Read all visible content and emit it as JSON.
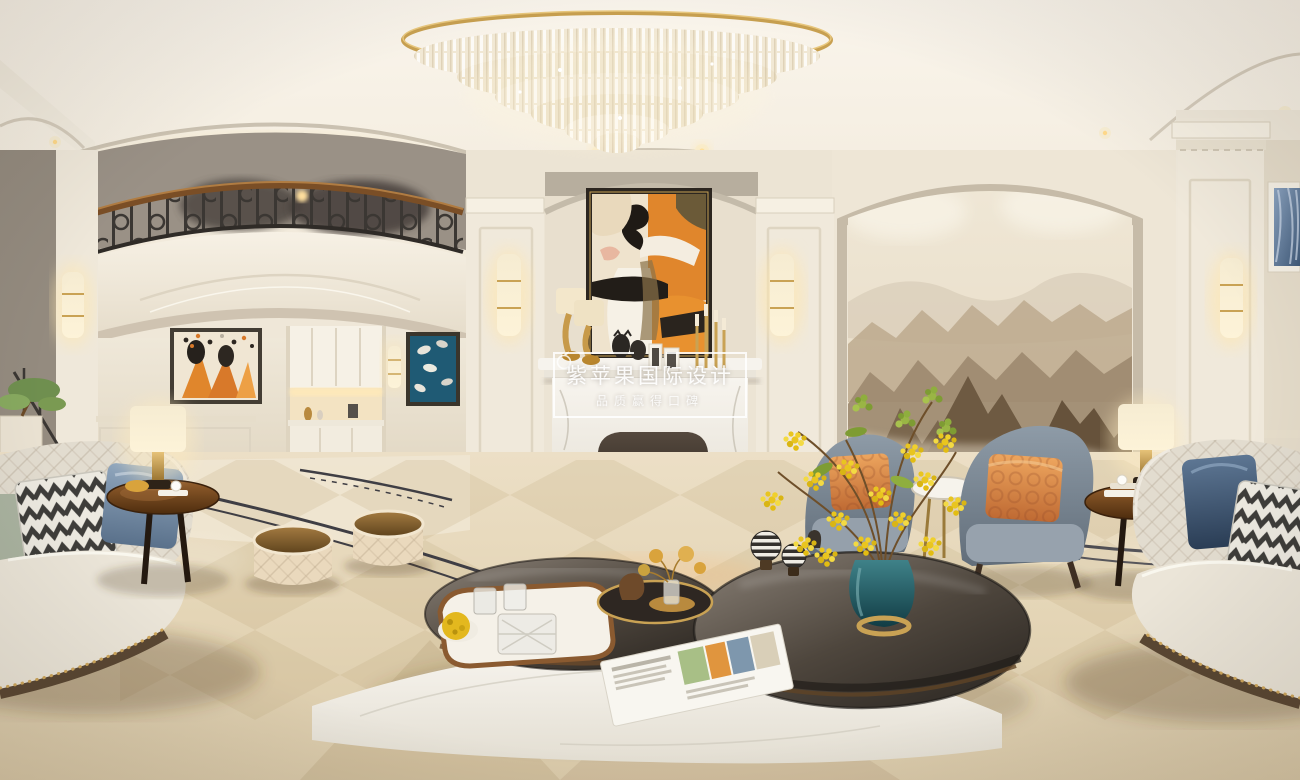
{
  "watermark": {
    "title": "紫苹果国际设计",
    "subtitle": "品质赢得口碑",
    "logo_icon": "apple-outline-icon"
  },
  "scene": {
    "kind": "360-degree interior panorama render",
    "room": "luxury neoclassical living room",
    "objects": [
      "crystal-chandelier",
      "wrought-iron-balcony-railing",
      "marble-fireplace",
      "fireplace-flames",
      "abstract-overmantel-painting",
      "wall-sconces",
      "ink-mountain-mural",
      "built-in-bar-cabinets",
      "orange-abstract-artwork",
      "blue-horse-artwork",
      "cream-tufted-sofas",
      "chevron-pillows",
      "navy-satin-pillows",
      "gray-armchairs",
      "orange-patterned-pillows",
      "drum-stools",
      "round-glass-coffee-tables",
      "curved-marble-platform",
      "teal-vase-yellow-flowers",
      "wood-side-tables",
      "drum-shade-table-lamps",
      "marble-diamond-floor",
      "dark-floor-inlay",
      "magazine",
      "crystal-tray-set",
      "bonsai-plant",
      "blue-curtain-window"
    ],
    "palette": {
      "ceiling": "#f8f2e7",
      "wall_cream": "#efe7d8",
      "wall_recess": "#e6dccb",
      "trim_gray": "#b9b0a0",
      "floor": "#e6d8bc",
      "floor_inlay_dark": "#3c3b42",
      "gold_accent": "#c9a254",
      "fire_orange": "#ff9b2e",
      "art_orange": "#e0862c",
      "mural_mountain": "#85755f",
      "sofa_cream": "#e6dfd2",
      "pillow_navy": "#33465f",
      "armchair_gray_blue": "#77848f",
      "pillow_orange": "#dd8a4d",
      "vase_teal": "#2c6a74",
      "flower_yellow": "#e9c51f",
      "leaf_green": "#93b23f",
      "wood_brown": "#7a4a26",
      "iron_railing": "#3b3733",
      "marble_white": "#f3efe7"
    }
  }
}
